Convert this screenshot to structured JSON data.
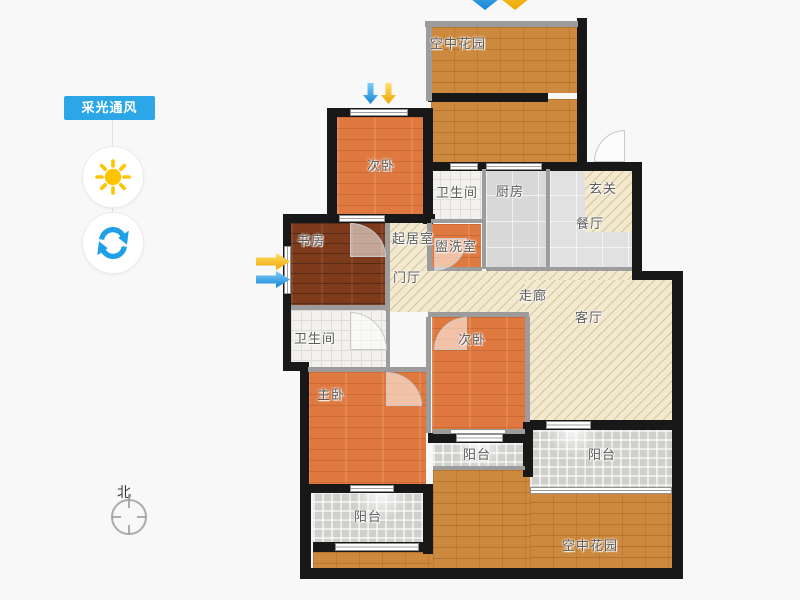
{
  "panel": {
    "badge_label": "采光通风",
    "buttons": [
      {
        "id": "sunlight",
        "icon": "sun-icon"
      },
      {
        "id": "rotate",
        "icon": "rotate-icon"
      }
    ]
  },
  "compass": {
    "north_label": "北"
  },
  "floorplan": {
    "rooms": {
      "garden_top": "空中花园",
      "bedroom_top": "次卧",
      "bath_top": "卫生间",
      "kitchen": "厨房",
      "entry": "玄关",
      "dining": "餐厅",
      "study": "书房",
      "sitting": "起居室",
      "washroom": "盥洗室",
      "foyer": "门厅",
      "corridor": "走廊",
      "living": "客厅",
      "bath_lower": "卫生间",
      "bedroom_mid": "次卧",
      "master": "主卧",
      "balcony_mid": "阳台",
      "balcony_left": "阳台",
      "balcony_right": "阳台",
      "garden_bottom": "空中花园"
    },
    "light_arrows": [
      {
        "location": "top-garden",
        "direction": "down",
        "colors": [
          "blue",
          "yellow"
        ]
      },
      {
        "location": "bedroom-top-window",
        "direction": "down",
        "colors": [
          "blue",
          "yellow"
        ]
      },
      {
        "location": "study-window",
        "direction": "right",
        "colors": [
          "yellow",
          "blue"
        ]
      }
    ],
    "colors": {
      "badge_blue": "#2ba7e8",
      "arrow_blue": "#1d8fe0",
      "arrow_yellow": "#f3ae00",
      "wall_black": "#181818",
      "wall_gray": "#9c9c9c",
      "wood_orange": "#e0793f",
      "wood_dark": "#7d3b1c",
      "wood_gold": "#cd8a3e",
      "tile_white": "#f2f1ed",
      "tile_gray": "#d8d8d8",
      "balcony_tile": "#cfcfcc",
      "hatch_beige": "#f3e9cf",
      "sun_yellow": "#ffc400"
    }
  }
}
